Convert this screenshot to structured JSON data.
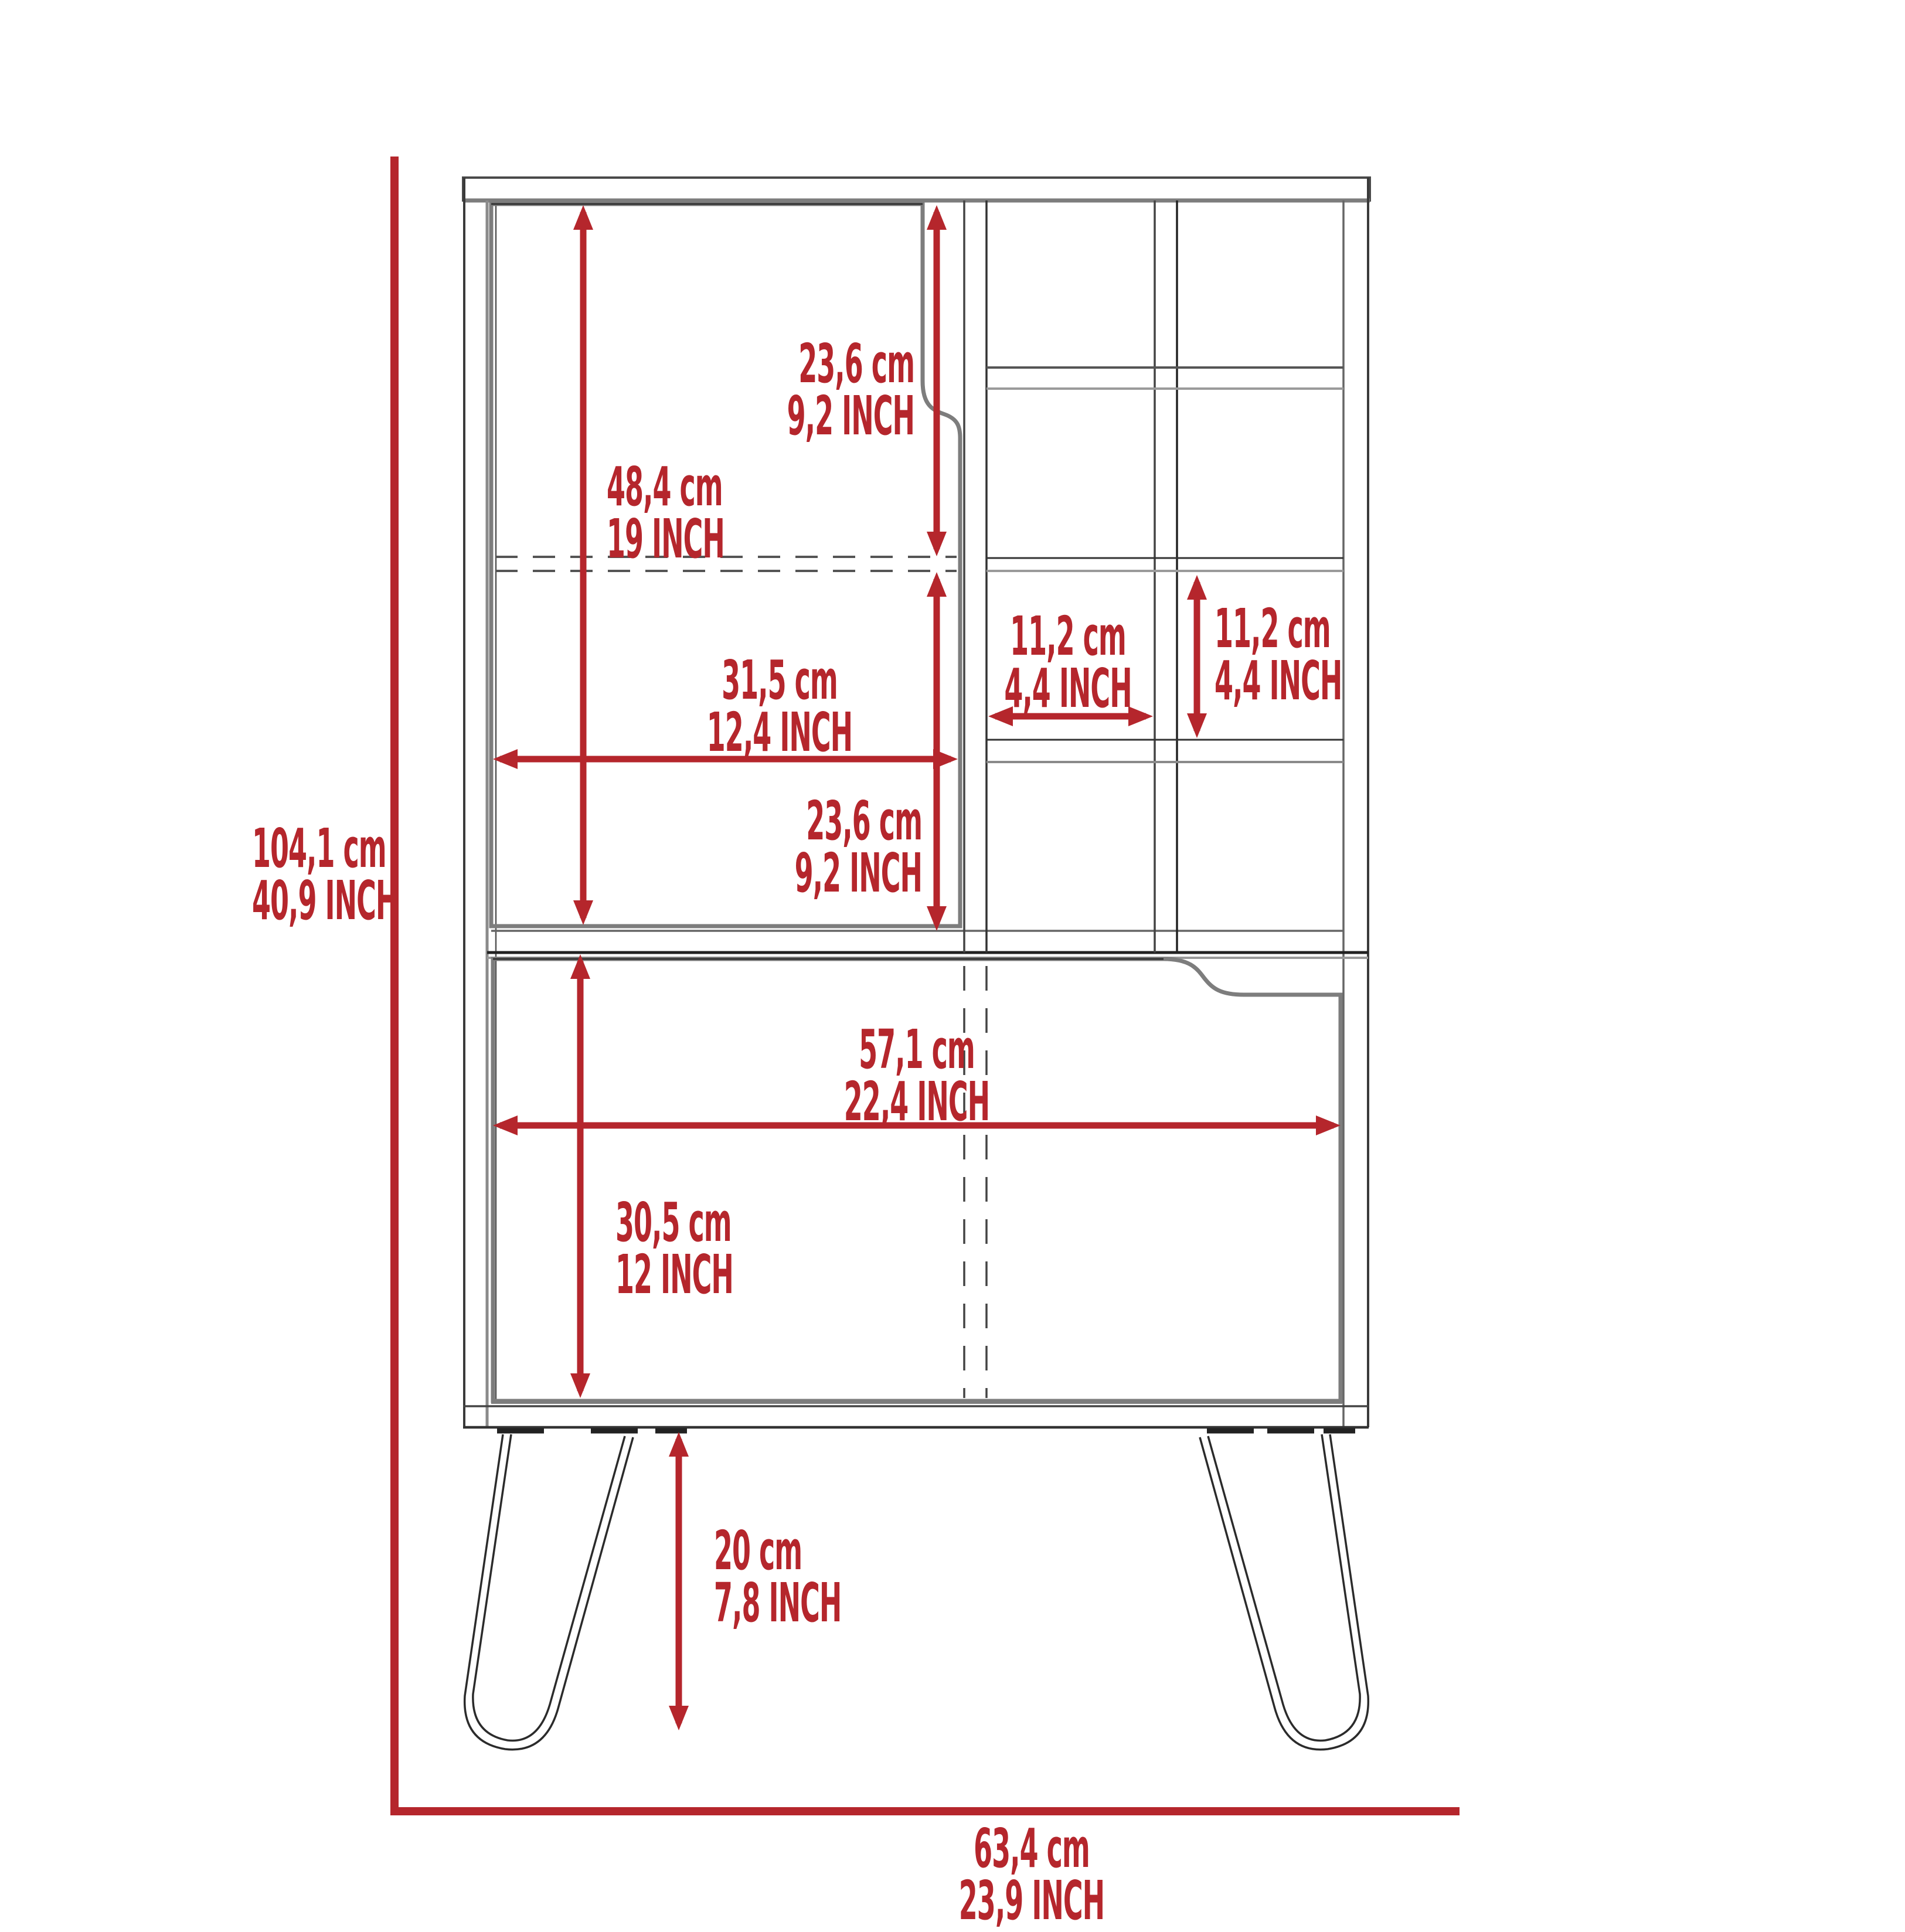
{
  "dimensions": {
    "overall_height": {
      "cm": "104,1 cm",
      "inch": "40,9 INCH"
    },
    "overall_width": {
      "cm": "63,4 cm",
      "inch": "23,9 INCH"
    },
    "upper_door_height": {
      "cm": "48,4 cm",
      "inch": "19 INCH"
    },
    "upper_door_top_section": {
      "cm": "23,6 cm",
      "inch": "9,2 INCH"
    },
    "upper_door_bottom_section": {
      "cm": "23,6 cm",
      "inch": "9,2 INCH"
    },
    "upper_door_width": {
      "cm": "31,5 cm",
      "inch": "12,4 INCH"
    },
    "wine_cubby_width": {
      "cm": "11,2 cm",
      "inch": "4,4 INCH"
    },
    "wine_cubby_height": {
      "cm": "11,2 cm",
      "inch": "4,4 INCH"
    },
    "lower_door_width": {
      "cm": "57,1 cm",
      "inch": "22,4 INCH"
    },
    "lower_door_height": {
      "cm": "30,5 cm",
      "inch": "12 INCH"
    },
    "leg_height": {
      "cm": "20 cm",
      "inch": "7,8 INCH"
    }
  },
  "colors": {
    "dimension_red": "#b5262c",
    "background": "#ffffff",
    "line_dark": "#3a3a3a",
    "line_gray": "#7d7d7d"
  }
}
